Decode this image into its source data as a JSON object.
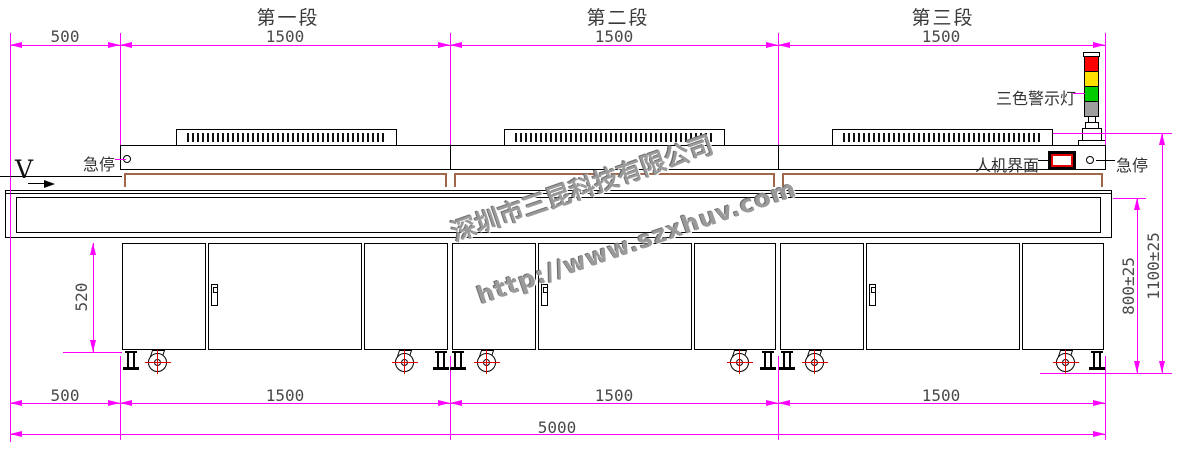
{
  "title_row": {
    "segments": [
      "第一段",
      "第二段",
      "第三段"
    ]
  },
  "dimensions": {
    "top": [
      "500",
      "1500",
      "1500",
      "1500"
    ],
    "bottom": [
      "500",
      "1500",
      "1500",
      "1500"
    ],
    "overall_length": "5000",
    "cabinet_height": "520",
    "belt_line_height": "800±25",
    "overall_height": "1100±25"
  },
  "labels": {
    "estop_left": "急停",
    "estop_right": "急停",
    "hmi": "人机界面",
    "tricolor_light": "三色警示灯",
    "direction_v": "V"
  },
  "watermark": {
    "company": "深圳市三昆科技有限公司",
    "website": "http://www.szxhuv.com"
  },
  "colors": {
    "dimension_line": "#FF00FF",
    "outline": "#000000",
    "belt_frame": "#A2674B",
    "light_red": "#FF0000",
    "light_yellow": "#FFE000",
    "light_green": "#00CC00",
    "light_pole_gray": "#9E9E9E",
    "dimension_text": "#4A4A4A",
    "watermark_gray": "#9A9A9A"
  }
}
